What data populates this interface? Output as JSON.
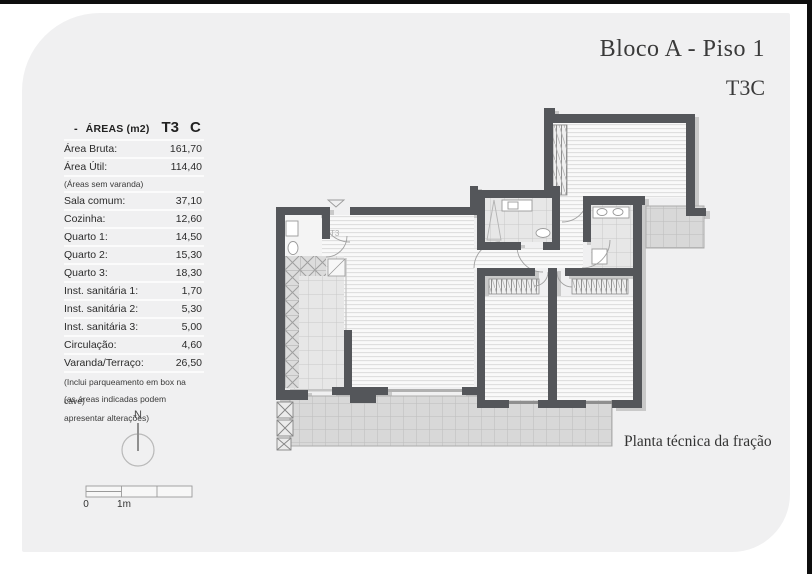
{
  "title": {
    "line1": "Bloco A - Piso 1",
    "line2": "T3C"
  },
  "areas_table": {
    "header": {
      "dash": "-",
      "label": "ÁREAS (m2)",
      "typology": "T3",
      "fraction": "C"
    },
    "rows": [
      {
        "label": "Área Bruta:",
        "value": "161,70"
      },
      {
        "label": "Área Útil:",
        "value": "114,40"
      },
      {
        "note": "(Áreas sem varanda)"
      },
      {
        "label": "Sala comum:",
        "value": "37,10"
      },
      {
        "label": "Cozinha:",
        "value": "12,60"
      },
      {
        "label": "Quarto 1:",
        "value": "14,50"
      },
      {
        "label": "Quarto 2:",
        "value": "15,30"
      },
      {
        "label": "Quarto 3:",
        "value": "18,30"
      },
      {
        "label": "Inst. sanitária 1:",
        "value": "1,70"
      },
      {
        "label": "Inst. sanitária 2:",
        "value": "5,30"
      },
      {
        "label": "Inst. sanitária 3:",
        "value": "5,00"
      },
      {
        "label": "Circulação:",
        "value": "4,60"
      },
      {
        "label": "Varanda/Terraço:",
        "value": "26,50"
      },
      {
        "note": "(Inclui parqueamento em box na cave)"
      },
      {
        "note": "(as áreas indicadas podem apresentar alterações)"
      }
    ]
  },
  "plan": {
    "t3_label": "T3",
    "caption": "Planta técnica da fração"
  },
  "compass": {
    "label": "N"
  },
  "scalebar": {
    "zero": "0",
    "one_meter": "1m"
  },
  "colors": {
    "wall": "#54565a",
    "card": "#f0f0f1",
    "frame": "#0e0e0e"
  }
}
